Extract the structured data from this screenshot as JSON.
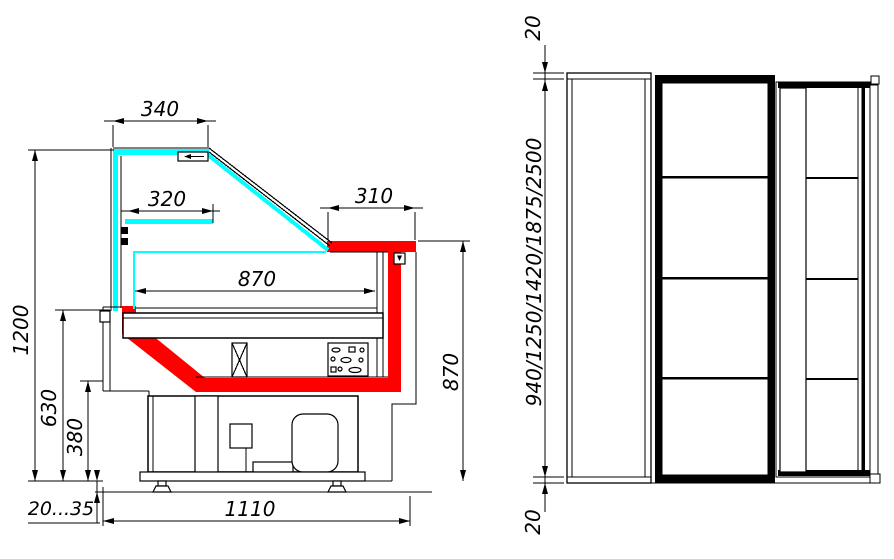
{
  "drawing": {
    "title": "refrigerated display counter — side section and front view",
    "colors": {
      "highlight": "#ff0000",
      "glass": "#00ffff",
      "line": "#000000",
      "bg": "#ffffff"
    },
    "side_view": {
      "labels": {
        "canopy_width": "340",
        "shelf_width": "320",
        "ledge_width": "310",
        "deck_width": "870",
        "overall_height": "1200",
        "glass_base_height": "630",
        "kick_height": "380",
        "counter_height": "870",
        "overall_depth": "1110",
        "feet_range": "20...35"
      }
    },
    "front_view": {
      "labels": {
        "top_gap": "20",
        "length_options": "940/1250/1420/1875/2500",
        "bottom_gap": "20"
      }
    }
  }
}
